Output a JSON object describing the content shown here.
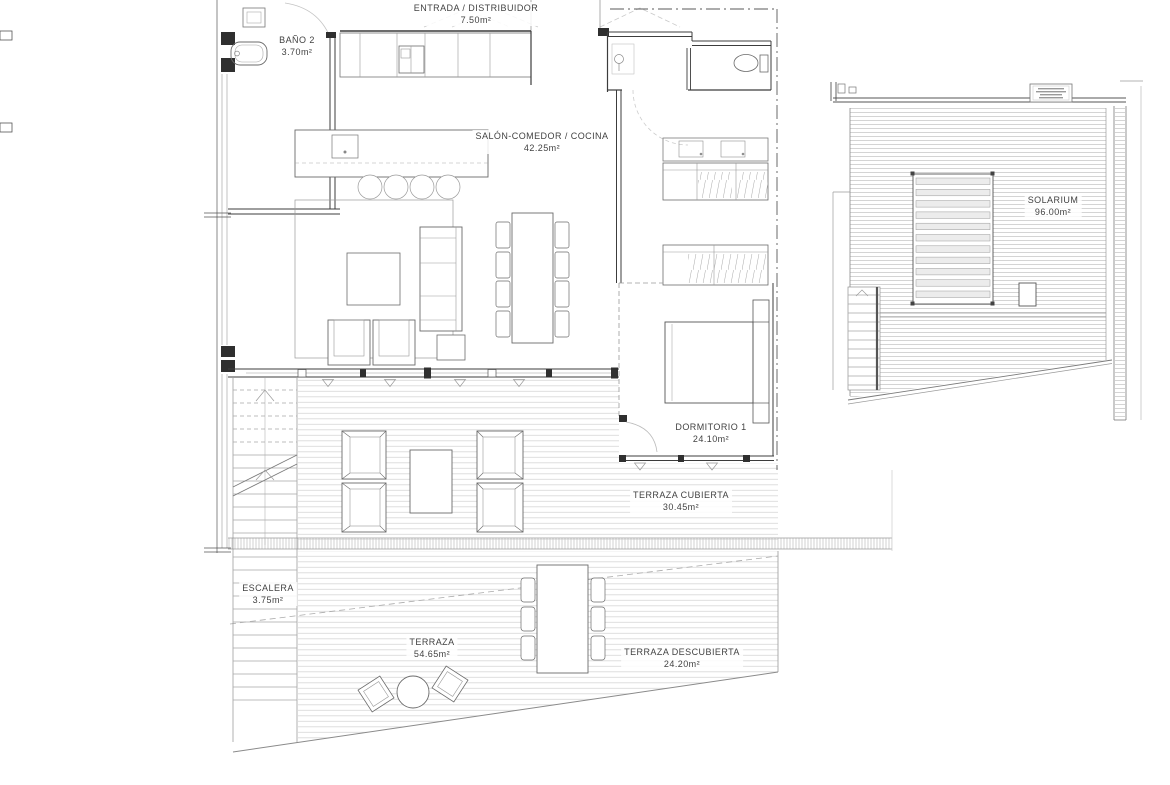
{
  "plan": {
    "rooms": [
      {
        "id": "entrada",
        "name": "ENTRADA / DISTRIBUIDOR",
        "area": "7.50m²"
      },
      {
        "id": "bano2",
        "name": "BAÑO 2",
        "area": "3.70m²"
      },
      {
        "id": "salon",
        "name": "SALÓN-COMEDOR / COCINA",
        "area": "42.25m²"
      },
      {
        "id": "dormitorio1",
        "name": "DORMITORIO 1",
        "area": "24.10m²"
      },
      {
        "id": "terraza_cubierta",
        "name": "TERRAZA CUBIERTA",
        "area": "30.45m²"
      },
      {
        "id": "escalera",
        "name": "ESCALERA",
        "area": "3.75m²"
      },
      {
        "id": "terraza",
        "name": "TERRAZA",
        "area": "54.65m²"
      },
      {
        "id": "terraza_descubierta",
        "name": "TERRAZA DESCUBIERTA",
        "area": "24.20m²"
      },
      {
        "id": "solarium",
        "name": "SOLARIUM",
        "area": "96.00m²"
      }
    ],
    "colors": {
      "background": "#ffffff",
      "wall": "#3c3c3c",
      "line": "#6b6b6b",
      "deck_stripe": "#dadada",
      "dash": "#9a9a9a",
      "label_text": "#424242"
    }
  }
}
